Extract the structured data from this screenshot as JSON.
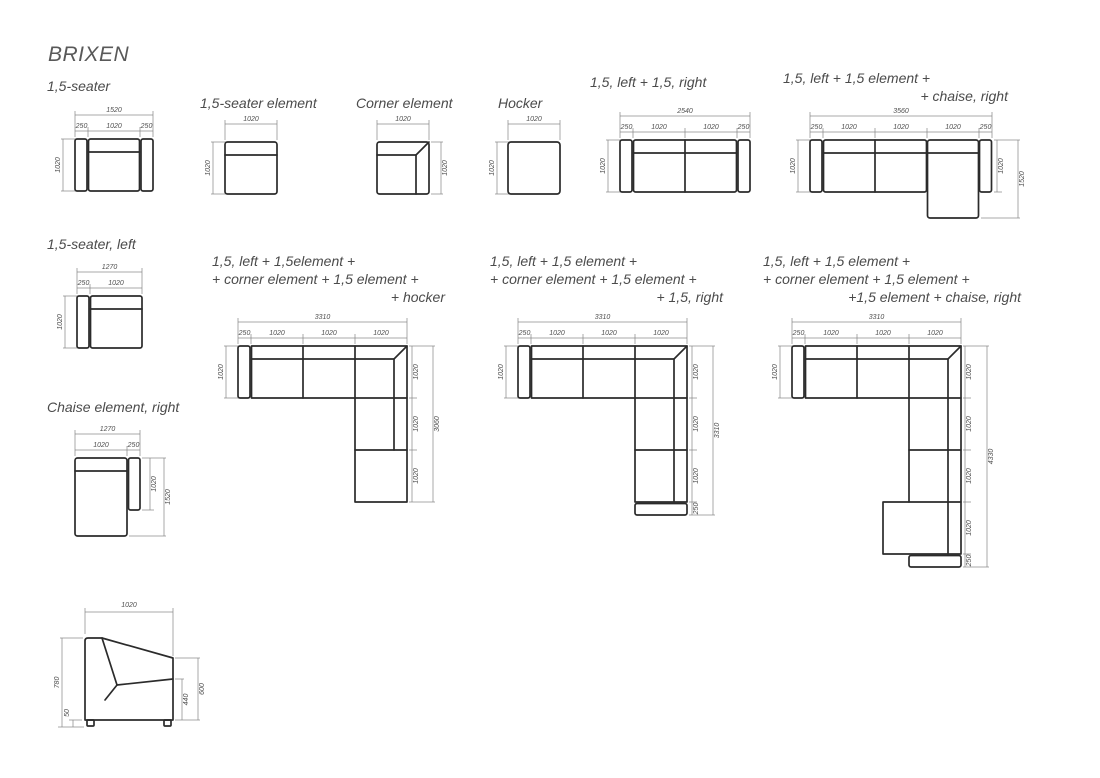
{
  "title": "BRIXEN",
  "line_color": "#2b2b2b",
  "dim_color": "#8c8c8c",
  "figures": {
    "f1": {
      "label": "1,5-seater",
      "total": "1520",
      "segs": [
        "250",
        "1020",
        "250"
      ],
      "depth": "1020"
    },
    "f2": {
      "label": "1,5-seater element",
      "width": "1020",
      "depth": "1020"
    },
    "f3": {
      "label": "Corner element",
      "width": "1020",
      "depth": "1020"
    },
    "f4": {
      "label": "Hocker",
      "width": "1020",
      "depth": "1020"
    },
    "f5": {
      "label": "1,5, left + 1,5, right",
      "total": "2540",
      "segs": [
        "250",
        "1020",
        "1020",
        "250"
      ],
      "depth": "1020"
    },
    "f6": {
      "label_line1": "1,5, left + 1,5 element +",
      "label_line2": "+ chaise, right",
      "total": "3560",
      "segs": [
        "250",
        "1020",
        "1020",
        "1020",
        "250"
      ],
      "depth": "1020",
      "right_segs": [
        "1020",
        "1520"
      ]
    },
    "f7": {
      "label": "1,5-seater, left",
      "total": "1270",
      "segs": [
        "250",
        "1020"
      ],
      "depth": "1020"
    },
    "f8": {
      "label": "Chaise element, right",
      "total": "1270",
      "segs": [
        "1020",
        "250"
      ],
      "right_segs": [
        "1020",
        "1520"
      ]
    },
    "f9": {
      "label_line1": "1,5, left + 1,5element +",
      "label_line2": "+ corner element + 1,5 element +",
      "label_line3": "+ hocker",
      "total": "3310",
      "segs": [
        "250",
        "1020",
        "1020",
        "1020"
      ],
      "depth": "1020",
      "right_segs": [
        "1020",
        "1020",
        "1020"
      ],
      "right_total": "3060"
    },
    "f10": {
      "label_line1": "1,5, left + 1,5 element +",
      "label_line2": "+ corner element + 1,5 element +",
      "label_line3": "+ 1,5, right",
      "total": "3310",
      "segs": [
        "250",
        "1020",
        "1020",
        "1020"
      ],
      "depth": "1020",
      "right_segs": [
        "1020",
        "1020",
        "1020",
        "250"
      ],
      "right_total": "3310"
    },
    "f11": {
      "label_line1": "1,5, left + 1,5 element +",
      "label_line2": "+ corner element + 1,5 element +",
      "label_line3": "+1,5 element + chaise, right",
      "total": "3310",
      "segs": [
        "250",
        "1020",
        "1020",
        "1020"
      ],
      "depth": "1020",
      "right_segs": [
        "1020",
        "1020",
        "1020",
        "1020",
        "250"
      ],
      "right_total": "4330"
    },
    "f12": {
      "width": "1020",
      "height": "780",
      "leg_height": "50",
      "seat_height": "440",
      "back_height": "600"
    }
  }
}
